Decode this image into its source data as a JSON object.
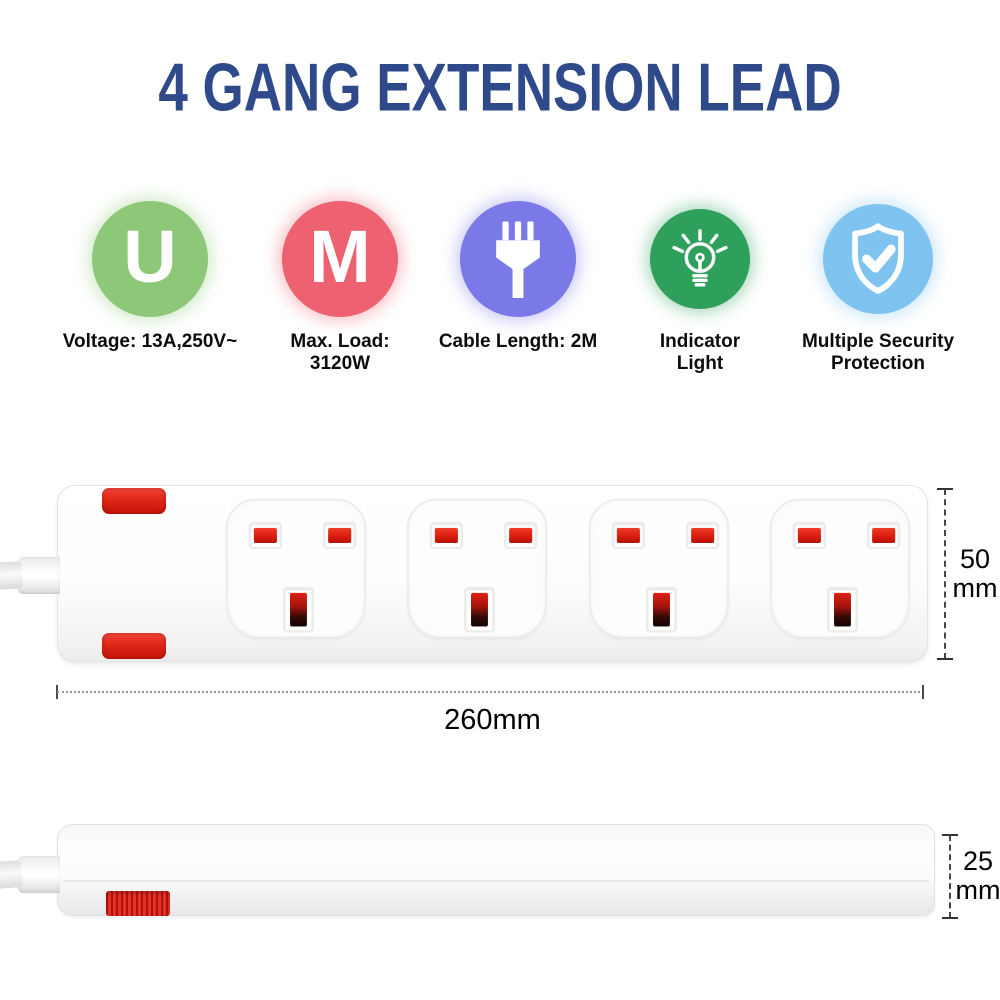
{
  "title": {
    "text": "4 GANG EXTENSION LEAD",
    "color": "#2e4a8a"
  },
  "features": [
    {
      "name": "voltage",
      "icon": "letter-u-icon",
      "glyph": "U",
      "color": "#8cc878",
      "line1": "Voltage: 13A,250V~",
      "line2": ""
    },
    {
      "name": "max-load",
      "icon": "letter-m-icon",
      "glyph": "M",
      "color": "#ee6170",
      "line1": "Max. Load:",
      "line2": "3120W"
    },
    {
      "name": "cable-length",
      "icon": "plug-icon",
      "color": "#7b79e8",
      "line1": "Cable Length: 2M",
      "line2": ""
    },
    {
      "name": "indicator-light",
      "icon": "light-bulb-icon",
      "color": "#2fa05c",
      "line1": "Indicator",
      "line2": "Light"
    },
    {
      "name": "security",
      "icon": "shield-check-icon",
      "color": "#7fc4f0",
      "line1": "Multiple Security",
      "line2": "Protection"
    }
  ],
  "dimensions": {
    "length": "260mm",
    "height_line1": "50",
    "height_line2": "mm",
    "depth_line1": "25",
    "depth_line2": "mm"
  },
  "product": {
    "socket_count": 4,
    "socket_red": "#dc1d10",
    "pilot_red": "#e02619",
    "body_color": "#fdfdfd"
  }
}
